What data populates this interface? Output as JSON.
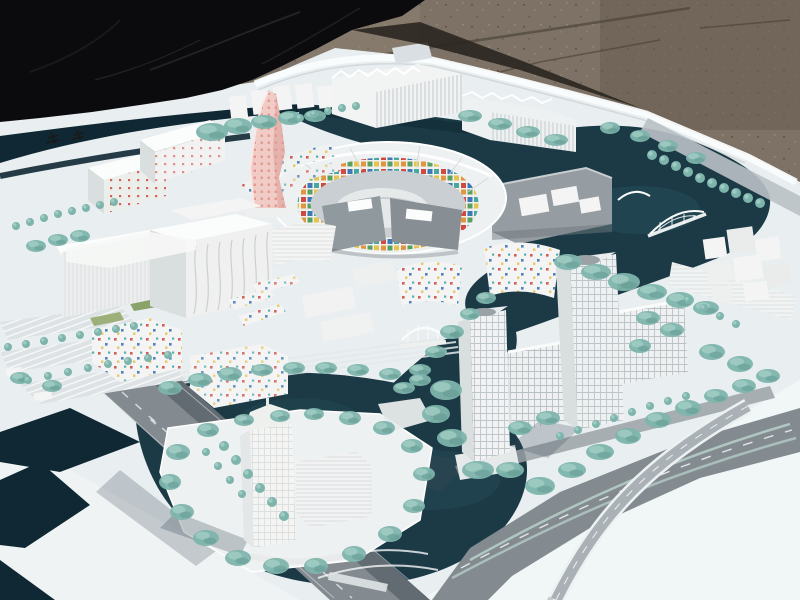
{
  "scene": {
    "type": "photograph",
    "subject": "architectural scale model of a waterfront city district",
    "surroundings": {
      "ground": "brown gravel pavement",
      "cover": "black tarp draped at upper left",
      "base": "white model baseboard with curved edge band"
    },
    "landmarks": [
      {
        "name": "pink-tower",
        "desc": "twisting pink high-rise with dotted facade"
      },
      {
        "name": "central-arena",
        "desc": "oval courtyard complex ringed with multicolor mosaic tiles"
      },
      {
        "name": "gray-slab-complex",
        "desc": "dark gray metal-clad blocks south and east of arena"
      },
      {
        "name": "west-complex",
        "desc": "large white building mass with wavy facade lines and parking lots"
      },
      {
        "name": "dotted-buildings",
        "desc": "white mid-rise blocks speckled with red, blue and yellow window tiles"
      },
      {
        "name": "twin-office-towers",
        "desc": "two tall white gridded towers with slab wings on the right"
      },
      {
        "name": "island-tower",
        "desc": "translucent white tower on an island in the southern basin"
      },
      {
        "name": "arched-bridge",
        "desc": "white arch bridge over eastern canal"
      },
      {
        "name": "truss-bridge",
        "desc": "small white bowstring bridge over southwest canal"
      },
      {
        "name": "canals",
        "desc": "dark teal water channels winding through the district"
      },
      {
        "name": "street-trees",
        "desc": "seafoam-green model trees in rows and clusters"
      },
      {
        "name": "highway-interchange",
        "desc": "gray roads and curved elevated ramp at lower right"
      }
    ]
  },
  "palette": {
    "tarp": "#0b0b0d",
    "gravel": "#7d7265",
    "gravel_dark": "#675d51",
    "gravel_light": "#8d8171",
    "board": "#e9eef0",
    "board_bright": "#f3f7f9",
    "edge": "#fafcfd",
    "water": "#1b3a46",
    "water_dark": "#0f2833",
    "water_light": "#2f5a66",
    "road": "#838b91",
    "road_dark": "#5d656b",
    "ramp": "#a9b1b6",
    "tree": "#7db4ac",
    "tree_light": "#a7d1c9",
    "tree_dark": "#5e948c",
    "building": "#f3f4f3",
    "building_shade": "#d9dedf",
    "building_dark": "#c3c9cc",
    "roof_white": "#fbfcfc",
    "gray_building": "#969da2",
    "gray_dark": "#7c8489",
    "pink": "#f1ccc7",
    "pink_dot": "#e29b93",
    "tile_red": "#cf4b41",
    "tile_blue": "#3e78b5",
    "tile_teal": "#47a8a2",
    "tile_orange": "#e2953f",
    "tile_yellow": "#e3c44e",
    "tile_green": "#58a060",
    "lawn": "#8aa36b"
  },
  "vegetation": {
    "ball_trees": [
      [
        652,
        155,
        5
      ],
      [
        664,
        160,
        5
      ],
      [
        676,
        166,
        5
      ],
      [
        688,
        172,
        5
      ],
      [
        700,
        178,
        5
      ],
      [
        712,
        183,
        5
      ],
      [
        724,
        188,
        5
      ],
      [
        736,
        193,
        5
      ],
      [
        748,
        198,
        5
      ],
      [
        760,
        203,
        5
      ],
      [
        16,
        226,
        4
      ],
      [
        30,
        222,
        4
      ],
      [
        44,
        218,
        4
      ],
      [
        58,
        214,
        4
      ],
      [
        72,
        211,
        4
      ],
      [
        86,
        208,
        4
      ],
      [
        100,
        205,
        4
      ],
      [
        114,
        202,
        4
      ],
      [
        8,
        347,
        4
      ],
      [
        26,
        344,
        4
      ],
      [
        44,
        341,
        4
      ],
      [
        62,
        338,
        4
      ],
      [
        80,
        335,
        4
      ],
      [
        98,
        332,
        4
      ],
      [
        116,
        329,
        4
      ],
      [
        134,
        326,
        4
      ],
      [
        28,
        380,
        4
      ],
      [
        48,
        376,
        4
      ],
      [
        68,
        372,
        4
      ],
      [
        88,
        368,
        4
      ],
      [
        108,
        364,
        4
      ],
      [
        128,
        361,
        4
      ],
      [
        148,
        358,
        4
      ],
      [
        168,
        355,
        4
      ],
      [
        224,
        446,
        5
      ],
      [
        236,
        460,
        5
      ],
      [
        248,
        474,
        5
      ],
      [
        260,
        488,
        5
      ],
      [
        272,
        502,
        5
      ],
      [
        284,
        516,
        5
      ],
      [
        206,
        452,
        4
      ],
      [
        218,
        466,
        4
      ],
      [
        230,
        480,
        4
      ],
      [
        242,
        494,
        4
      ],
      [
        560,
        436,
        4
      ],
      [
        578,
        430,
        4
      ],
      [
        596,
        424,
        4
      ],
      [
        614,
        418,
        4
      ],
      [
        632,
        412,
        4
      ],
      [
        650,
        406,
        4
      ],
      [
        668,
        401,
        4
      ],
      [
        686,
        396,
        4
      ],
      [
        688,
        300,
        4
      ],
      [
        704,
        308,
        4
      ],
      [
        720,
        316,
        4
      ],
      [
        736,
        324,
        4
      ],
      [
        300,
        118,
        4
      ],
      [
        314,
        114,
        4
      ],
      [
        328,
        111,
        4
      ],
      [
        342,
        108,
        4
      ],
      [
        356,
        106,
        4
      ]
    ],
    "tree_clusters": [
      [
        212,
        132,
        16,
        9
      ],
      [
        238,
        126,
        14,
        8
      ],
      [
        264,
        122,
        13,
        7
      ],
      [
        290,
        118,
        12,
        7
      ],
      [
        315,
        116,
        11,
        6
      ],
      [
        470,
        116,
        12,
        6
      ],
      [
        500,
        124,
        12,
        6
      ],
      [
        528,
        132,
        12,
        6
      ],
      [
        556,
        140,
        12,
        6
      ],
      [
        610,
        128,
        10,
        6
      ],
      [
        640,
        136,
        10,
        6
      ],
      [
        668,
        146,
        10,
        6
      ],
      [
        696,
        158,
        10,
        6
      ],
      [
        568,
        262,
        14,
        8
      ],
      [
        596,
        272,
        15,
        8
      ],
      [
        624,
        282,
        16,
        9
      ],
      [
        652,
        292,
        15,
        8
      ],
      [
        680,
        300,
        14,
        8
      ],
      [
        706,
        308,
        13,
        7
      ],
      [
        452,
        332,
        12,
        7
      ],
      [
        470,
        314,
        10,
        6
      ],
      [
        486,
        298,
        10,
        6
      ],
      [
        436,
        352,
        11,
        6
      ],
      [
        420,
        370,
        11,
        6
      ],
      [
        404,
        388,
        11,
        6
      ],
      [
        446,
        390,
        16,
        10
      ],
      [
        436,
        414,
        14,
        9
      ],
      [
        452,
        438,
        15,
        9
      ],
      [
        478,
        470,
        16,
        9
      ],
      [
        510,
        470,
        14,
        8
      ],
      [
        540,
        486,
        15,
        9
      ],
      [
        572,
        470,
        14,
        8
      ],
      [
        600,
        452,
        14,
        8
      ],
      [
        628,
        436,
        13,
        8
      ],
      [
        658,
        420,
        13,
        8
      ],
      [
        688,
        408,
        13,
        8
      ],
      [
        716,
        396,
        12,
        7
      ],
      [
        744,
        386,
        12,
        7
      ],
      [
        648,
        318,
        12,
        7
      ],
      [
        672,
        330,
        12,
        7
      ],
      [
        640,
        346,
        11,
        7
      ],
      [
        712,
        352,
        13,
        8
      ],
      [
        740,
        364,
        13,
        8
      ],
      [
        768,
        376,
        12,
        7
      ],
      [
        170,
        388,
        12,
        7
      ],
      [
        200,
        380,
        12,
        7
      ],
      [
        230,
        374,
        12,
        7
      ],
      [
        262,
        370,
        11,
        6
      ],
      [
        294,
        368,
        11,
        6
      ],
      [
        326,
        368,
        11,
        6
      ],
      [
        358,
        370,
        11,
        6
      ],
      [
        390,
        374,
        11,
        6
      ],
      [
        420,
        380,
        11,
        6
      ],
      [
        178,
        452,
        12,
        8
      ],
      [
        170,
        482,
        11,
        8
      ],
      [
        182,
        512,
        12,
        8
      ],
      [
        206,
        538,
        13,
        8
      ],
      [
        238,
        558,
        13,
        8
      ],
      [
        276,
        566,
        13,
        8
      ],
      [
        316,
        566,
        12,
        8
      ],
      [
        354,
        554,
        12,
        8
      ],
      [
        390,
        534,
        12,
        8
      ],
      [
        414,
        506,
        11,
        7
      ],
      [
        424,
        474,
        11,
        7
      ],
      [
        412,
        446,
        11,
        7
      ],
      [
        384,
        428,
        11,
        7
      ],
      [
        350,
        418,
        11,
        7
      ],
      [
        314,
        414,
        10,
        6
      ],
      [
        280,
        416,
        10,
        6
      ],
      [
        244,
        420,
        10,
        6
      ],
      [
        208,
        430,
        11,
        7
      ],
      [
        36,
        246,
        10,
        6
      ],
      [
        58,
        240,
        10,
        6
      ],
      [
        80,
        236,
        10,
        6
      ],
      [
        548,
        418,
        12,
        7
      ],
      [
        520,
        428,
        12,
        7
      ],
      [
        20,
        378,
        10,
        6
      ],
      [
        52,
        386,
        10,
        6
      ]
    ]
  }
}
